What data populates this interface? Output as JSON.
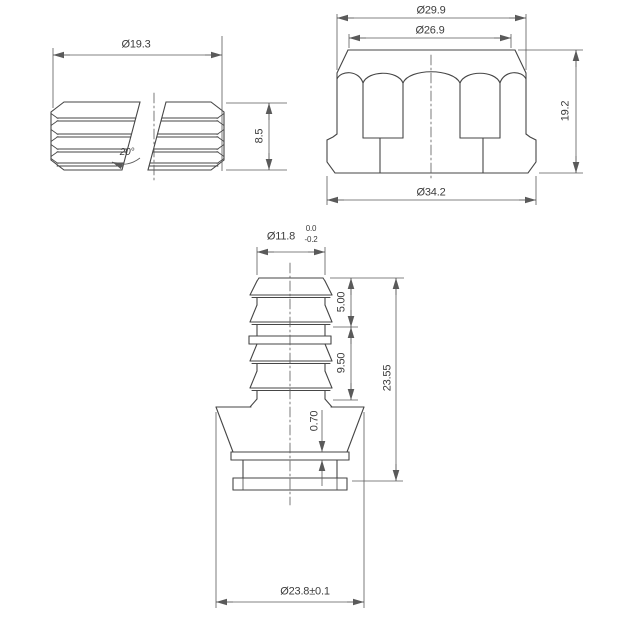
{
  "drawing": {
    "type": "engineering-drawing",
    "background_color": "#ffffff",
    "line_color": "#464646",
    "dim_line_color": "#5a5a5a",
    "text_color": "#3c3c3c",
    "views": {
      "split_ring": {
        "name": "split ribbed ring - top left view",
        "outer_diameter": "Ø19.3",
        "height": "8.5",
        "gap_angle": "20°"
      },
      "nut": {
        "name": "fluted nut - top right view",
        "top_outer_diameter": "Ø29.9",
        "top_face_diameter": "Ø26.9",
        "height": "19.2",
        "base_diameter": "Ø34.2"
      },
      "barb_fitting": {
        "name": "barbed fitting - bottom view",
        "stem_diameter": "Ø11.8",
        "stem_tolerance_upper": "0.0",
        "stem_tolerance_lower": "-0.2",
        "upper_barb_length": "5.00",
        "lower_barb_length": "9.50",
        "overall_length": "23.55",
        "collar_thickness": "0.70",
        "base_diameter": "Ø23.8±0.1"
      }
    }
  }
}
